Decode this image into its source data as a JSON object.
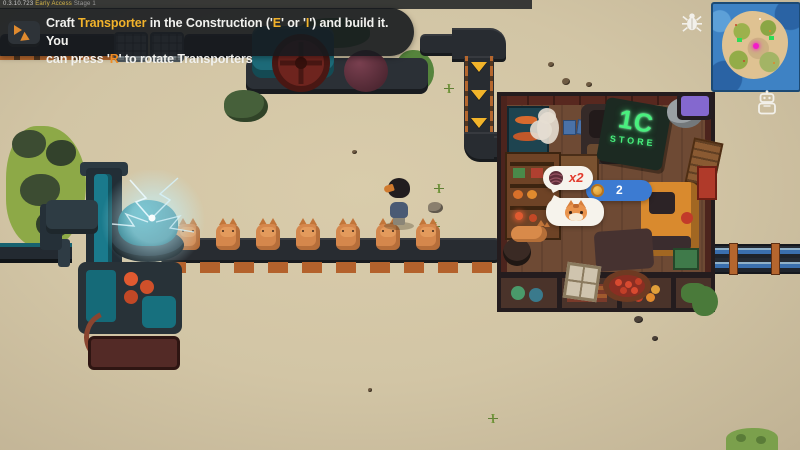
{
  "hud": {
    "version_text": {
      "v1": "0.3.10.723",
      "v2": "Early Access",
      "v3": "Stage 1"
    },
    "tutorial_banner": {
      "s1": "Craft ",
      "s2": "Transporter",
      "s3": " in the Construction ('",
      "s4": "E",
      "s5": "' or '",
      "s6": "I",
      "s7": "') and build it. You",
      "s8": "can press '",
      "s9": "R",
      "s10": "' to rotate Transporters"
    },
    "minimap": {
      "player_marker_color": "#f21cc8"
    },
    "buttons": {
      "bug_report": "bug-icon",
      "robot_helper": "robot-icon"
    }
  },
  "world": {
    "store": {
      "sign_line1": "1C",
      "sign_line2": "STORE",
      "sign_color": "#49f07e"
    },
    "trade_bubbles": {
      "yarn_offer": {
        "icon": "yarn-ball-icon",
        "label": "x2",
        "label_color": "#e23a2c"
      },
      "coin_price": {
        "icon": "coin-icon",
        "label": "2",
        "pill_color": "#3c7bd2"
      },
      "cat_request": {
        "icon": "cat-face-icon"
      }
    },
    "conveyor": {
      "cat_count": 7
    }
  },
  "icons": {
    "bug_report": "bug-icon",
    "robot_helper": "robot-icon",
    "transporter": "transporter-icon",
    "belt_arrow": "chevron-down-arrow",
    "yarn_ball": "yarn-ball-icon",
    "coin": "coin-icon",
    "cat_face": "cat-face-icon"
  },
  "colors": {
    "accent_yellow": "#f2b32b",
    "key_orange": "#ef8c24",
    "bubble_blue": "#3c7bd2",
    "label_red": "#e23a2c",
    "neon_green": "#49f07e",
    "sand": "#d2c5a5",
    "teal_machine": "#1f8a96"
  }
}
